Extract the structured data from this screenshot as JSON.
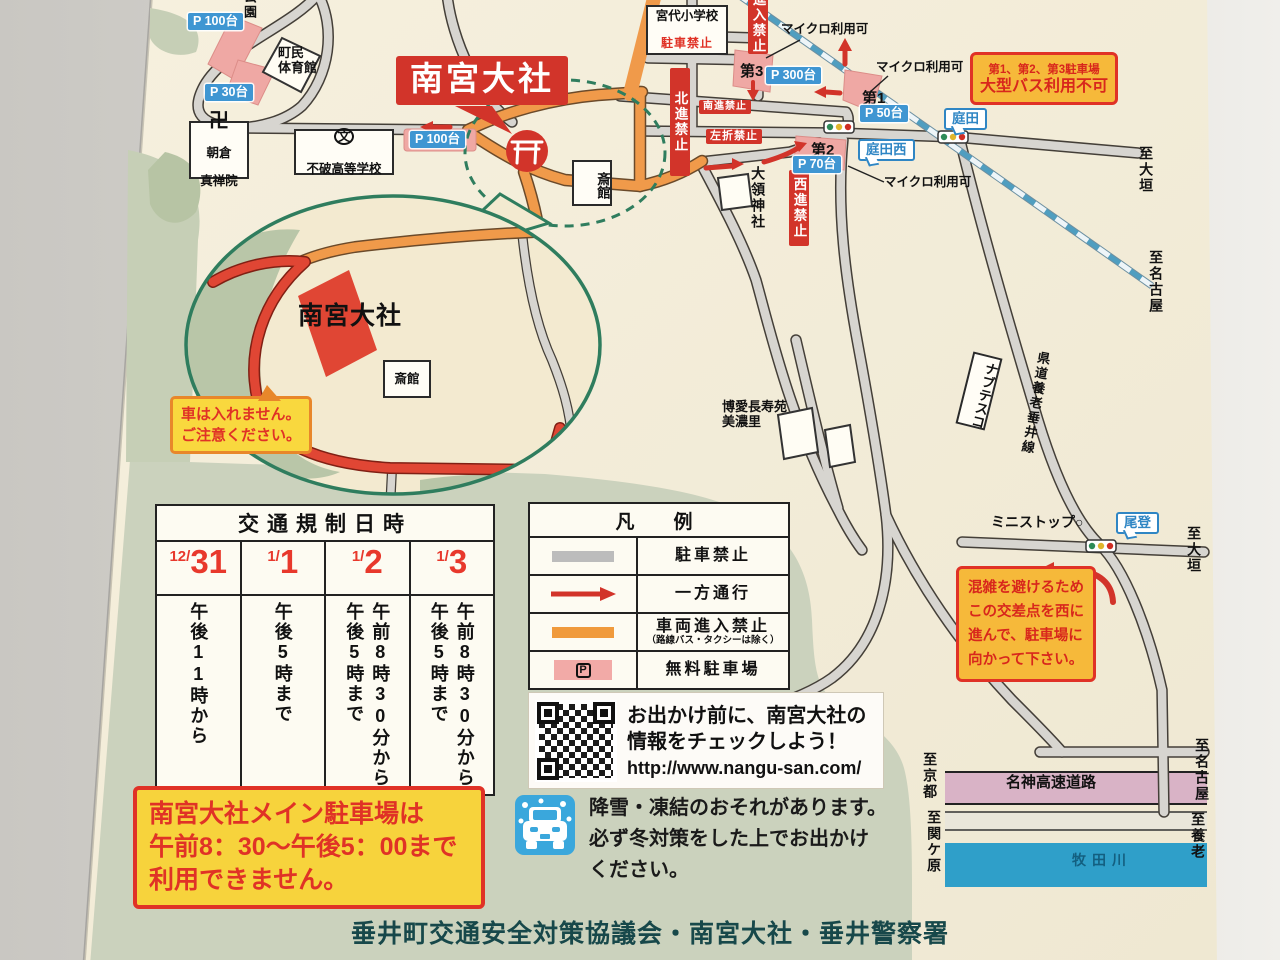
{
  "colors": {
    "accent_red": "#d2342a",
    "note_yellow": "#f7d33c",
    "note_orange": "#f6b93a",
    "orange_road": "#f09a4a",
    "parking_pink": "#efa9a5",
    "p_label_blue": "#3f96d2",
    "bubble_blue": "#2f86c4",
    "land_cream": "#f3ead0",
    "green": "#cbd2bd",
    "rail_blue": "#4f9ec0",
    "river_blue": "#2f9fc9",
    "highway_pink": "#d9b3c6",
    "footer_teal": "#17484a"
  },
  "map": {
    "labels": [
      {
        "name": "park-label-100-nw",
        "cls": "plabel",
        "x": 188,
        "y": 13,
        "text": "P 100台"
      },
      {
        "name": "park-label-30",
        "cls": "plabel",
        "x": 205,
        "y": 84,
        "text": "P 30台"
      },
      {
        "name": "park-area-park-label",
        "cls": "plain v sm",
        "x": 241,
        "y": -10,
        "h": 42,
        "text": "公園"
      },
      {
        "name": "chomin-gym-label",
        "cls": "plain sm",
        "x": 278,
        "y": 46,
        "lines": [
          "町民",
          "体育館"
        ]
      },
      {
        "name": "asakura-shinzenin-box",
        "cls": "wbox",
        "x": 189,
        "y": 121,
        "w": 60,
        "h": 58,
        "mark": "卍",
        "lines": [
          "朝倉",
          "真禅院"
        ]
      },
      {
        "name": "fuwa-highschool-box",
        "cls": "wbox school",
        "x": 294,
        "y": 129,
        "w": 100,
        "h": 46,
        "mark": "文",
        "text": "不破高等学校"
      },
      {
        "name": "nangu-taisha-title",
        "cls": "title-box",
        "x": 396,
        "y": 56,
        "text": "南宮大社"
      },
      {
        "name": "park-label-100-shrine",
        "cls": "plabel",
        "x": 410,
        "y": 131,
        "text": "P 100台"
      },
      {
        "name": "saikan-box-main",
        "cls": "wbox v",
        "x": 572,
        "y": 160,
        "w": 40,
        "h": 46,
        "text": "斎館"
      },
      {
        "name": "miyashiro-elementary-box",
        "cls": "wbox school2",
        "x": 646,
        "y": 5,
        "w": 82,
        "h": 50,
        "text": "宮代小学校",
        "sub": "駐車禁止"
      },
      {
        "name": "no-entry-sign",
        "cls": "rsign v",
        "x": 748,
        "y": -12,
        "h": 58,
        "text": "進入禁止"
      },
      {
        "name": "no-north-sign",
        "cls": "rsign v",
        "x": 670,
        "y": 68,
        "h": 100,
        "text": "北進禁止"
      },
      {
        "name": "no-south-sign",
        "cls": "rsign h sm",
        "x": 699,
        "y": 100,
        "text": "南進禁止"
      },
      {
        "name": "no-left-turn-sign",
        "cls": "rsign h",
        "x": 706,
        "y": 129,
        "text": "左折禁止"
      },
      {
        "name": "no-west-sign",
        "cls": "rsign v",
        "x": 789,
        "y": 170,
        "h": 68,
        "text": "西進禁止"
      },
      {
        "name": "micro-bus-ok-1",
        "cls": "micro",
        "x": 781,
        "y": 22,
        "text": "マイクロ利用可"
      },
      {
        "name": "micro-bus-ok-2",
        "cls": "micro",
        "x": 876,
        "y": 60,
        "text": "マイクロ利用可"
      },
      {
        "name": "micro-bus-ok-3",
        "cls": "micro",
        "x": 884,
        "y": 175,
        "text": "マイクロ利用可"
      },
      {
        "name": "lot3-label",
        "cls": "plain b",
        "x": 740,
        "y": 63,
        "text": "第3"
      },
      {
        "name": "park-label-300",
        "cls": "plabel",
        "x": 766,
        "y": 67,
        "text": "P 300台"
      },
      {
        "name": "lot1-label",
        "cls": "plain b",
        "x": 862,
        "y": 90,
        "text": "第1"
      },
      {
        "name": "park-label-50",
        "cls": "plabel",
        "x": 860,
        "y": 105,
        "text": "P 50台"
      },
      {
        "name": "lot2-label",
        "cls": "plain b",
        "x": 811,
        "y": 142,
        "text": "第2"
      },
      {
        "name": "park-label-70",
        "cls": "plabel",
        "x": 793,
        "y": 156,
        "text": "P 70台"
      },
      {
        "name": "bus-restriction-box",
        "cls": "obox",
        "x": 970,
        "y": 52,
        "lines": [
          "第1、第2、第3駐車場",
          "大型バス利用不可"
        ]
      },
      {
        "name": "niwata-bubble",
        "cls": "bubble",
        "x": 944,
        "y": 108,
        "text": "庭田"
      },
      {
        "name": "niwata-nishi-bubble",
        "cls": "bubble",
        "x": 858,
        "y": 139,
        "text": "庭田西"
      },
      {
        "name": "dairyo-shrine-label",
        "cls": "plain v",
        "x": 750,
        "y": 166,
        "h": 76,
        "text": "大領神社"
      },
      {
        "name": "to-ogaki-label-1",
        "cls": "plain v",
        "x": 1138,
        "y": 146,
        "h": 62,
        "text": "至大垣"
      },
      {
        "name": "to-nagoya-label-1",
        "cls": "plain v",
        "x": 1148,
        "y": 250,
        "h": 80,
        "text": "至名古屋"
      },
      {
        "name": "hakuai-chojuen-label",
        "cls": "plain sm",
        "x": 722,
        "y": 400,
        "lines": [
          "博愛長寿苑",
          "美濃里"
        ]
      },
      {
        "name": "nabtesco-box",
        "cls": "wbox v",
        "x": 964,
        "y": 354,
        "w": 30,
        "h": 74,
        "text": "ナブテスコ",
        "rot": 14
      },
      {
        "name": "kendo-yoro-tarui-label",
        "cls": "plain v sm",
        "x": 1022,
        "y": 350,
        "h": 158,
        "text": "県道養老垂井線",
        "rot": 10
      },
      {
        "name": "ministop-label",
        "cls": "plain",
        "x": 991,
        "y": 514,
        "text": "ミニストップ○"
      },
      {
        "name": "otari-bubble",
        "cls": "bubble",
        "x": 1116,
        "y": 512,
        "text": "尾登"
      },
      {
        "name": "to-ogaki-label-2",
        "cls": "plain v",
        "x": 1186,
        "y": 526,
        "h": 64,
        "text": "至大垣"
      },
      {
        "name": "congestion-note",
        "cls": "obox note",
        "x": 956,
        "y": 566,
        "lines": [
          "混雑を避けるため",
          "この交差点を西に",
          "進んで、駐車場に",
          "向かって下さい。"
        ]
      },
      {
        "name": "meishin-expressway-label",
        "cls": "plain b",
        "x": 1006,
        "y": 774,
        "text": "名神高速道路"
      },
      {
        "name": "to-kyoto-label",
        "cls": "plain v",
        "x": 922,
        "y": 752,
        "h": 62,
        "text": "至京都"
      },
      {
        "name": "to-nagoya-label-2",
        "cls": "plain v",
        "x": 1194,
        "y": 738,
        "h": 80,
        "text": "至名古屋"
      },
      {
        "name": "to-sekigahara-label",
        "cls": "plain v",
        "x": 926,
        "y": 810,
        "h": 82,
        "text": "至関ケ原"
      },
      {
        "name": "to-yoro-label",
        "cls": "plain v",
        "x": 1190,
        "y": 812,
        "h": 62,
        "text": "至養老"
      },
      {
        "name": "river-label",
        "cls": "river",
        "x": 1072,
        "y": 852,
        "text": "牧田川"
      },
      {
        "name": "inset-shrine-label",
        "cls": "inset-name",
        "x": 298,
        "y": 302,
        "text": "南宮大社"
      },
      {
        "name": "saikan-box-inset",
        "cls": "wbox",
        "x": 383,
        "y": 360,
        "w": 48,
        "h": 38,
        "text": "斎館"
      },
      {
        "name": "no-cars-callout",
        "cls": "callout",
        "x": 170,
        "y": 396,
        "lines": [
          "車は入れません。",
          "ご注意ください。"
        ]
      }
    ]
  },
  "schedule": {
    "title": "交通規制日時",
    "columns": [
      {
        "d_small": "12/",
        "d_big": "31",
        "time": "午後11時から"
      },
      {
        "d_small": "1/",
        "d_big": "1",
        "time": "午後5時まで"
      },
      {
        "d_small": "1/",
        "d_big": "2",
        "time": "午前8時30分から午後5時まで"
      },
      {
        "d_small": "1/",
        "d_big": "3",
        "time": "午前8時30分から午後5時まで"
      }
    ]
  },
  "legend": {
    "title": "凡　例",
    "items": [
      {
        "label": "駐車禁止",
        "type": "gray"
      },
      {
        "label": "一方通行",
        "type": "red-arrow"
      },
      {
        "label": "車両進入禁止",
        "sub": "（路線バス・タクシーは除く）",
        "type": "orange"
      },
      {
        "label": "無料駐車場",
        "type": "pink-parking"
      }
    ]
  },
  "qr": {
    "line1": "お出かけ前に、南宮大社の",
    "line2": "情報をチェックしよう！",
    "url": "http://www.nangu-san.com/"
  },
  "notes": {
    "main_parking": [
      "南宮大社メイン駐車場は",
      "午前8：30～午後5：00まで",
      "利用できません。"
    ],
    "snow": [
      "降雪・凍結のおそれがあります。",
      "必ず冬対策をした上でお出かけ",
      "ください。"
    ]
  },
  "footer": {
    "text": "垂井町交通安全対策協議会・南宮大社・垂井警察署"
  }
}
